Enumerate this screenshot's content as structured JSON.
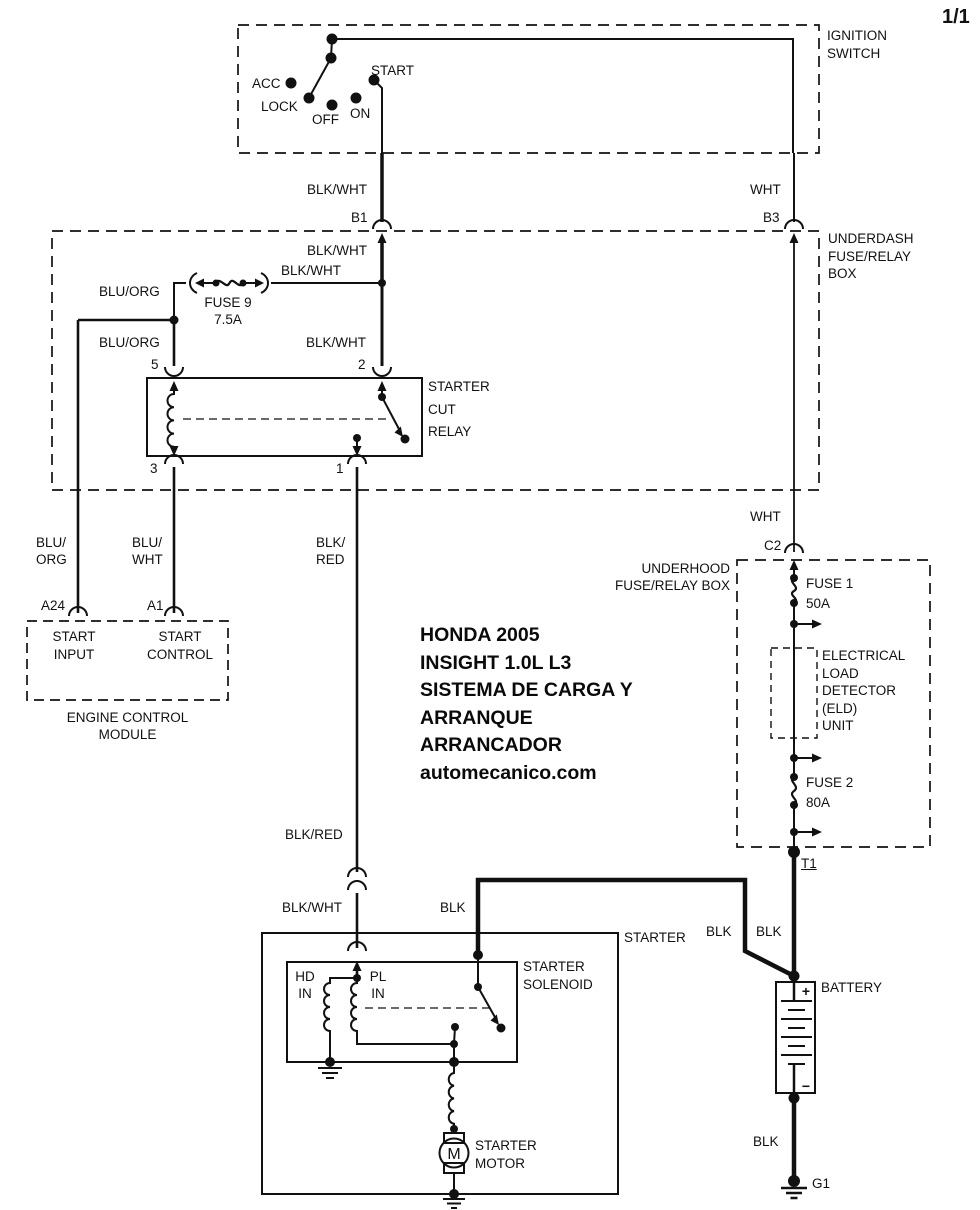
{
  "page": {
    "indicator": "1/1"
  },
  "title_block": {
    "lines": [
      "HONDA 2005",
      "INSIGHT 1.0L L3",
      "SISTEMA DE CARGA Y",
      "ARRANQUE",
      "ARRANCADOR",
      "automecanico.com"
    ]
  },
  "ignition_switch": {
    "label": [
      "IGNITION",
      "SWITCH"
    ],
    "positions": {
      "acc": "ACC",
      "lock": "LOCK",
      "off": "OFF",
      "on": "ON",
      "start": "START"
    }
  },
  "underdash_box": {
    "label": [
      "UNDERDASH",
      "FUSE/RELAY",
      "BOX"
    ]
  },
  "underhood_box": {
    "label": [
      "UNDERHOOD",
      "FUSE/RELAY BOX"
    ]
  },
  "fuses": {
    "fuse9": {
      "name": "FUSE 9",
      "rating": "7.5A"
    },
    "fuse1": {
      "name": "FUSE 1",
      "rating": "50A"
    },
    "fuse2": {
      "name": "FUSE 2",
      "rating": "80A"
    }
  },
  "eld_unit": {
    "label": [
      "ELECTRICAL",
      "LOAD",
      "DETECTOR",
      "(ELD)",
      "UNIT"
    ]
  },
  "starter_cut_relay": {
    "label": [
      "STARTER",
      "CUT",
      "RELAY"
    ],
    "pins": {
      "pin5": "5",
      "pin2": "2",
      "pin3": "3",
      "pin1": "1"
    }
  },
  "ecm": {
    "label": [
      "ENGINE CONTROL",
      "MODULE"
    ],
    "pin_a24": "A24",
    "pin_a1": "A1",
    "start_input": [
      "START",
      "INPUT"
    ],
    "start_control": [
      "START",
      "CONTROL"
    ]
  },
  "starter": {
    "label": "STARTER",
    "solenoid_label": [
      "STARTER",
      "SOLENOID"
    ],
    "hd_in": [
      "HD",
      "IN"
    ],
    "pl_in": [
      "PL",
      "IN"
    ],
    "motor_label": [
      "STARTER",
      "MOTOR"
    ],
    "motor_symbol": "M"
  },
  "battery": {
    "label": "BATTERY",
    "plus": "+",
    "minus": "−"
  },
  "terminals": {
    "b1": "B1",
    "b3": "B3",
    "c2": "C2",
    "t1": "T1"
  },
  "grounds": {
    "g1": "G1"
  },
  "wire_labels": {
    "ign_start": "BLK/WHT",
    "ign_batt": "WHT",
    "b1_in": "BLK/WHT",
    "fuse9_out": "BLK/WHT",
    "relay_pin2": "BLK/WHT",
    "fuse9_in": "BLU/ORG",
    "relay_pin5": "BLU/ORG",
    "ecm_a24": [
      "BLU/",
      "ORG"
    ],
    "ecm_a1": [
      "BLU/",
      "WHT"
    ],
    "relay_pin1": [
      "BLK/",
      "RED"
    ],
    "underdash_out": "WHT",
    "solenoid_upper": "BLK/RED",
    "solenoid_in": "BLK/WHT",
    "solenoid_blk": "BLK",
    "batt_from_solenoid": "BLK",
    "batt_from_t1": "BLK",
    "batt_neg": "BLK"
  },
  "colors": {
    "ink": "#111111",
    "background": "#ffffff"
  }
}
